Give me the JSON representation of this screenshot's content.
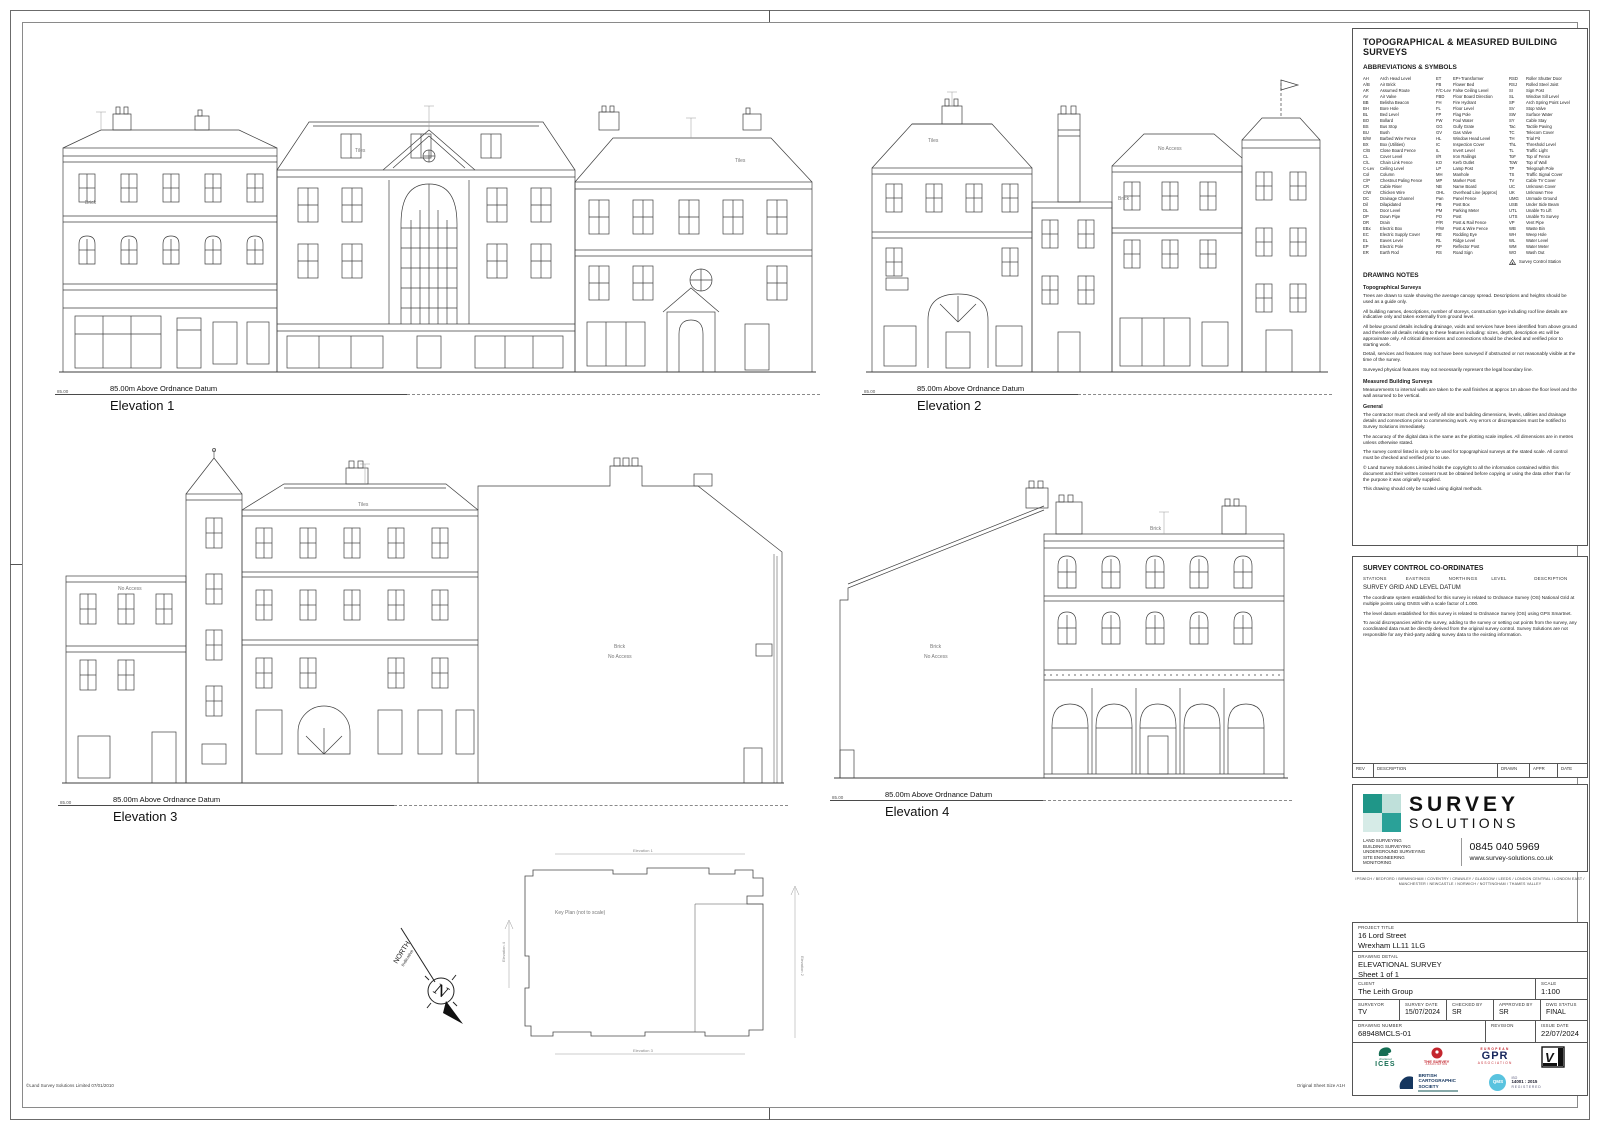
{
  "sheet": {
    "footer_left": "©Land Survey Solutions Limited 07/01/2010",
    "footer_right": "Original Sheet Size A1H"
  },
  "ann": {
    "brick": "Brick",
    "tiles": "Tiles",
    "no_access": "No Access"
  },
  "elevations": [
    {
      "label": "Elevation 1",
      "datum": "85.00m Above Ordnance Datum",
      "datum_val": "85.00"
    },
    {
      "label": "Elevation 2",
      "datum": "85.00m Above Ordnance Datum",
      "datum_val": "85.00"
    },
    {
      "label": "Elevation 3",
      "datum": "85.00m Above Ordnance Datum",
      "datum_val": "85.00"
    },
    {
      "label": "Elevation 4",
      "datum": "85.00m Above Ordnance Datum",
      "datum_val": "85.00"
    }
  ],
  "key_plan": {
    "label": "Key Plan (not to scale)",
    "sights": [
      "Elevation 1",
      "Elevation 2",
      "Elevation 3",
      "Elevation 4"
    ]
  },
  "north": {
    "label": "NORTH",
    "sub": "Indicative"
  },
  "panel": {
    "title": "TOPOGRAPHICAL & MEASURED BUILDING SURVEYS",
    "abbr_heading": "ABBREVIATIONS & SYMBOLS",
    "abbr_col1": [
      [
        "AH",
        "Arch Head Level"
      ],
      [
        "A/B",
        "Air Brick"
      ],
      [
        "AR",
        "Assumed Route"
      ],
      [
        "AV",
        "Air Valve"
      ],
      [
        "BB",
        "Belisha Beacon"
      ],
      [
        "BH",
        "Bore Hole"
      ],
      [
        "BL",
        "Bed Level"
      ],
      [
        "BO",
        "Bollard"
      ],
      [
        "BS",
        "Bus Stop"
      ],
      [
        "BU",
        "Bush"
      ],
      [
        "B/W",
        "Barbed Wire Fence"
      ],
      [
        "BX",
        "Box (Utilities)"
      ],
      [
        "C/B",
        "Close Board Fence"
      ],
      [
        "CL",
        "Cover Level"
      ],
      [
        "C/L",
        "Chain Link Fence"
      ],
      [
        "C-Lev",
        "Ceiling Level"
      ],
      [
        "Col",
        "Column"
      ],
      [
        "C/P",
        "Chestnut Paling Fence"
      ],
      [
        "CR",
        "Cable Riser"
      ],
      [
        "C/W",
        "Chicken Wire"
      ],
      [
        "DC",
        "Drainage Channel"
      ],
      [
        "Dil",
        "Dilapidated"
      ],
      [
        "DL",
        "Door Level"
      ],
      [
        "DP",
        "Down Pipe"
      ],
      [
        "DR",
        "Drain"
      ],
      [
        "EBx",
        "Electric Box"
      ],
      [
        "EC",
        "Electric Supply Cover"
      ],
      [
        "EL",
        "Eaves Level"
      ],
      [
        "EP",
        "Electric Pole"
      ],
      [
        "ER",
        "Earth Rod"
      ]
    ],
    "abbr_col2": [
      [
        "ET",
        "EP+Transformer"
      ],
      [
        "FB",
        "Flower Bed"
      ],
      [
        "F/C-Lev",
        "False Ceiling Level"
      ],
      [
        "FBD",
        "Floor Board Direction"
      ],
      [
        "FH",
        "Fire Hydrant"
      ],
      [
        "FL",
        "Floor Level"
      ],
      [
        "FP",
        "Flag Pole"
      ],
      [
        "FW",
        "Foul Water"
      ],
      [
        "GG",
        "Gully Grate"
      ],
      [
        "GV",
        "Gas Valve"
      ],
      [
        "HL",
        "Window Head Level"
      ],
      [
        "IC",
        "Inspection Cover"
      ],
      [
        "IL",
        "Invert Level"
      ],
      [
        "I/R",
        "Iron Railings"
      ],
      [
        "KO",
        "Kerb Outlet"
      ],
      [
        "LP",
        "Lamp Post"
      ],
      [
        "MH",
        "Manhole"
      ],
      [
        "MP",
        "Marker Post"
      ],
      [
        "NB",
        "Name Board"
      ],
      [
        "OHL",
        "Overhead Line (approx)"
      ],
      [
        "Pan",
        "Panel Fence"
      ],
      [
        "PB",
        "Post Box"
      ],
      [
        "PM",
        "Parking Meter"
      ],
      [
        "PO",
        "Post"
      ],
      [
        "P/R",
        "Post & Rail Fence"
      ],
      [
        "P/W",
        "Post & Wire Fence"
      ],
      [
        "RE",
        "Rodding Eye"
      ],
      [
        "RL",
        "Ridge Level"
      ],
      [
        "RP",
        "Reflector Post"
      ],
      [
        "RS",
        "Road Sign"
      ]
    ],
    "abbr_col3": [
      [
        "RSD",
        "Roller Shutter Door"
      ],
      [
        "RSJ",
        "Rolled Steel Joist"
      ],
      [
        "SI",
        "Sign Post"
      ],
      [
        "SL",
        "Window Sill Level"
      ],
      [
        "SP",
        "Arch Spring Point Level"
      ],
      [
        "SV",
        "Stop Valve"
      ],
      [
        "SW",
        "Surface Water"
      ],
      [
        "SY",
        "Cable Stay"
      ],
      [
        "Tac",
        "Tactile Paving"
      ],
      [
        "TC",
        "Telecom Cover"
      ],
      [
        "TH",
        "Trial Pit"
      ],
      [
        "ThL",
        "Threshold Level"
      ],
      [
        "TL",
        "Traffic Light"
      ],
      [
        "ToF",
        "Top of Fence"
      ],
      [
        "ToW",
        "Top of Wall"
      ],
      [
        "TP",
        "Telegraph Pole"
      ],
      [
        "TS",
        "Traffic Signal Cover"
      ],
      [
        "TV",
        "Cable TV Cover"
      ],
      [
        "UC",
        "Unknown Cover"
      ],
      [
        "UK",
        "Unknown Tree"
      ],
      [
        "UMG",
        "Unmade Ground"
      ],
      [
        "USB",
        "Under Side Beam"
      ],
      [
        "UTL",
        "Unable To Lift"
      ],
      [
        "UTS",
        "Unable To Survey"
      ],
      [
        "VP",
        "Vent Pipe"
      ],
      [
        "WB",
        "Waste Bin"
      ],
      [
        "WH",
        "Weep Hole"
      ],
      [
        "WL",
        "Water Level"
      ],
      [
        "WM",
        "Water Meter"
      ],
      [
        "WO",
        "Wash Out"
      ]
    ],
    "abbr_station": "Survey Control Station",
    "notes_heading": "DRAWING NOTES",
    "notes": [
      {
        "c": "nh",
        "t": "Topographical Surveys"
      },
      {
        "c": "np",
        "t": "Trees are drawn to scale showing the average canopy spread. Descriptions and heights should be used as a guide only."
      },
      {
        "c": "np",
        "t": "All building names, descriptions, number of storeys, construction type including roof line details are indicative only and taken externally from ground level."
      },
      {
        "c": "np",
        "t": "All below ground details including drainage, voids and services have been identified from above ground and therefore all details relating to these features including: sizes, depth, description etc will be approximate only. All critical dimensions and connections should be checked and verified prior to starting work."
      },
      {
        "c": "np",
        "t": "Detail, services and features may not have been surveyed if obstructed or not reasonably visible at the time of the survey."
      },
      {
        "c": "np",
        "t": "Surveyed physical features may not necessarily represent the legal boundary line."
      },
      {
        "c": "nh",
        "t": "Measured Building Surveys"
      },
      {
        "c": "np",
        "t": "Measurements to internal walls are taken to the wall finishes at approx 1m above the floor level and the wall assumed to be vertical."
      },
      {
        "c": "nh",
        "t": "General"
      },
      {
        "c": "np",
        "t": "The contractor must check and verify all site and building dimensions, levels, utilities and drainage details and connections prior to commencing work.  Any errors or discrepancies must be notified to Survey Solutions immediately."
      },
      {
        "c": "np",
        "t": "The accuracy of the digital data is the same as the plotting scale implies. All dimensions are in metres unless otherwise stated."
      },
      {
        "c": "np",
        "t": "The survey control listed is only to be used for topographical surveys at the stated scale.  All control must be checked and verified prior to use."
      },
      {
        "c": "np",
        "t": "© Land Survey Solutions Limited holds the copyright to all the information contained within this document and their written consent must be obtained before copying or using the data other than for the purpose it was originally supplied."
      },
      {
        "c": "np",
        "t": "This drawing should only be scaled using digital methods."
      }
    ],
    "control": {
      "heading": "SURVEY CONTROL CO-ORDINATES",
      "cols": [
        "STATIONS",
        "EASTINGS",
        "NORTHINGS",
        "LEVEL",
        "DESCRIPTION"
      ],
      "sub": "SURVEY GRID AND LEVEL DATUM",
      "paras": [
        "The coordinate system established for this survey is related to Ordnance Survey (OS) National Grid at multiple points using GNSS with a scale factor of 1.000.",
        "The level datum established for this survey is related to Ordnance Survey (OS) using GPS Smartnet.",
        "To avoid discrepancies within the survey, adding to the survey or setting out points from the survey, any coordinated data must be directly derived from the original survey control. Survey Solutions are not responsible for any third-party adding survey data to the existing information."
      ]
    },
    "rev": [
      "REV",
      "DESCRIPTION",
      "DRAWN",
      "APPR",
      "DATE"
    ],
    "brand": {
      "name1": "SURVEY",
      "name2": "SOLUTIONS",
      "services": [
        "LAND SURVEYING",
        "BUILDING SURVEYING",
        "UNDERGROUND SURVEYING",
        "SITE ENGINEERING",
        "MONITORING"
      ],
      "phone": "0845 040 5969",
      "web": "www.survey-solutions.co.uk",
      "locations": "IPSWICH / BEDFORD / BIRMINGHAM / COVENTRY / CRAWLEY / GLASGOW / LEEDS / LONDON CENTRAL / LONDON EAST / MANCHESTER / NEWCASTLE / NORWICH / NOTTINGHAM / THAMES VALLEY"
    },
    "title_block": {
      "l_project": "PROJECT TITLE",
      "project1": "16 Lord Street",
      "project2": "Wrexham LL11 1LG",
      "l_detail": "DRAWING DETAIL",
      "detail1": "ELEVATIONAL SURVEY",
      "detail2": "Sheet 1 of 1",
      "l_client": "CLIENT",
      "client": "The Leith Group",
      "l_scale": "SCALE",
      "scale": "1:100",
      "l_surveyor": "SURVEYOR",
      "surveyor": "TV",
      "l_survey_date": "SURVEY DATE",
      "survey_date": "15/07/2024",
      "l_checked": "CHECKED BY",
      "checked": "SR",
      "l_approved": "APPROVED BY",
      "approved": "SR",
      "l_status": "DWG STATUS",
      "status": "FINAL",
      "l_number": "DRAWING NUMBER",
      "number": "68948MCLS-01",
      "l_revision": "REVISION",
      "revision": "",
      "l_issue": "ISSUE DATE",
      "issue": "22/07/2024"
    },
    "logos": {
      "ices_top": "chartered",
      "ices": "ICES",
      "tsa1": "THE SURVEY",
      "tsa2": "ASSOCIATION",
      "gpr_top": "EUROPEAN",
      "gpr": "GPR",
      "gpr_sub": "ASSOCIATION",
      "bcs1": "BRITISH",
      "bcs2": "CARTOGRAPHIC",
      "bcs3": "SOCIETY",
      "qms": "QMS",
      "qms1": "ISO",
      "qms2": "14001 : 2015",
      "qms3": "REGISTERED"
    }
  },
  "colors": {
    "teal_dark": "#1f9688",
    "teal_mid": "#4fb3a5",
    "teal_light": "#bfe0da",
    "teal_pale": "#d6ebe7",
    "qms_blue": "#59c3df",
    "ices_green": "#166e54",
    "tsa_red": "#c4262e",
    "gpr_navy": "#16265c",
    "bcs_navy": "#15365f"
  }
}
